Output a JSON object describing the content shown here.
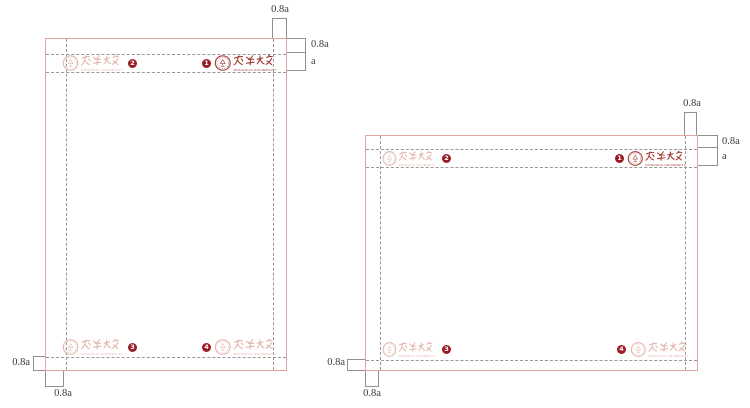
{
  "labels": {
    "dim_small": "0.8a",
    "dim_large": "a"
  },
  "logo": {
    "zh": "东华大学",
    "en": "DONGHUA UNIVERSITY"
  },
  "colors": {
    "logo_red": "#a23a31",
    "logo_faded_pink": "#e1b6aa",
    "badge_red": "#9b1c22",
    "page_border_pink": "#e2a59f",
    "guide_gray": "#979797",
    "dimension_gray": "#8f8f8f"
  },
  "pages": [
    {
      "name": "portrait-page",
      "logos": [
        {
          "pos": "top-left",
          "badge": "2",
          "style": "faded"
        },
        {
          "pos": "top-right",
          "badge": "1",
          "style": "solid"
        },
        {
          "pos": "bottom-left",
          "badge": "3",
          "style": "faded"
        },
        {
          "pos": "bottom-right",
          "badge": "4",
          "style": "faded"
        }
      ]
    },
    {
      "name": "landscape-page",
      "logos": [
        {
          "pos": "top-left",
          "badge": "2",
          "style": "faded"
        },
        {
          "pos": "top-right",
          "badge": "1",
          "style": "solid"
        },
        {
          "pos": "bottom-left",
          "badge": "3",
          "style": "faded"
        },
        {
          "pos": "bottom-right",
          "badge": "4",
          "style": "faded"
        }
      ]
    }
  ]
}
